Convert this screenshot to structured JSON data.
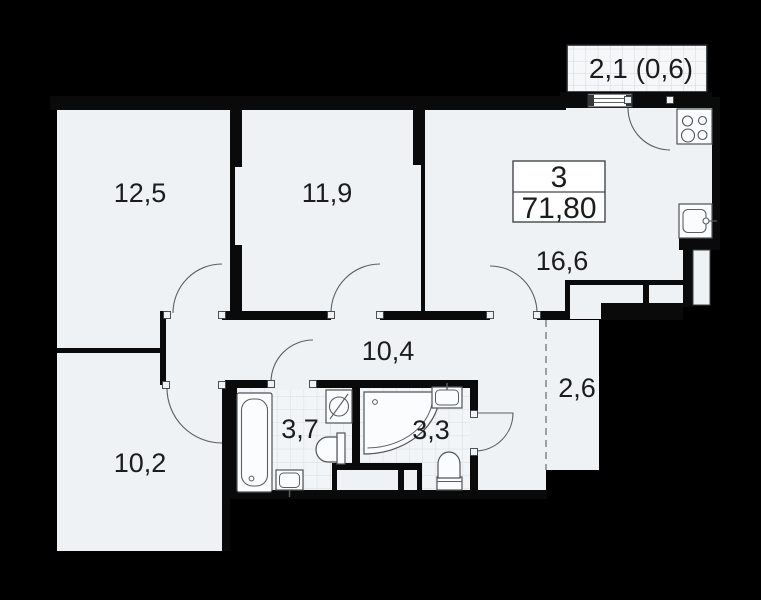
{
  "apartment": {
    "rooms_count": "3",
    "total_area": "71,80"
  },
  "balcony": {
    "area_label": "2,1 (0,6)"
  },
  "rooms": [
    {
      "key": "bedroom-1",
      "area_label": "12,5"
    },
    {
      "key": "bedroom-2",
      "area_label": "11,9"
    },
    {
      "key": "kitchen-living",
      "area_label": "16,6"
    },
    {
      "key": "hallway",
      "area_label": "10,4"
    },
    {
      "key": "corridor",
      "area_label": "2,6"
    },
    {
      "key": "bathroom",
      "area_label": "3,7"
    },
    {
      "key": "wc",
      "area_label": "3,3"
    },
    {
      "key": "bedroom-3",
      "area_label": "10,2"
    }
  ],
  "fixtures": [
    "bathtub",
    "washing-machine",
    "toilet",
    "sink",
    "corner-shower",
    "stove",
    "kitchen-sink",
    "window",
    "balcony",
    "duct"
  ],
  "colors": {
    "background": "#000000",
    "floor": "#eef2f5",
    "wall": "#0a0a0a",
    "tile_line": "#d9dde0",
    "balcony_fill": "#f5f7f8",
    "dashed_line": "#9aa0a3",
    "text": "#1c1c1c"
  }
}
